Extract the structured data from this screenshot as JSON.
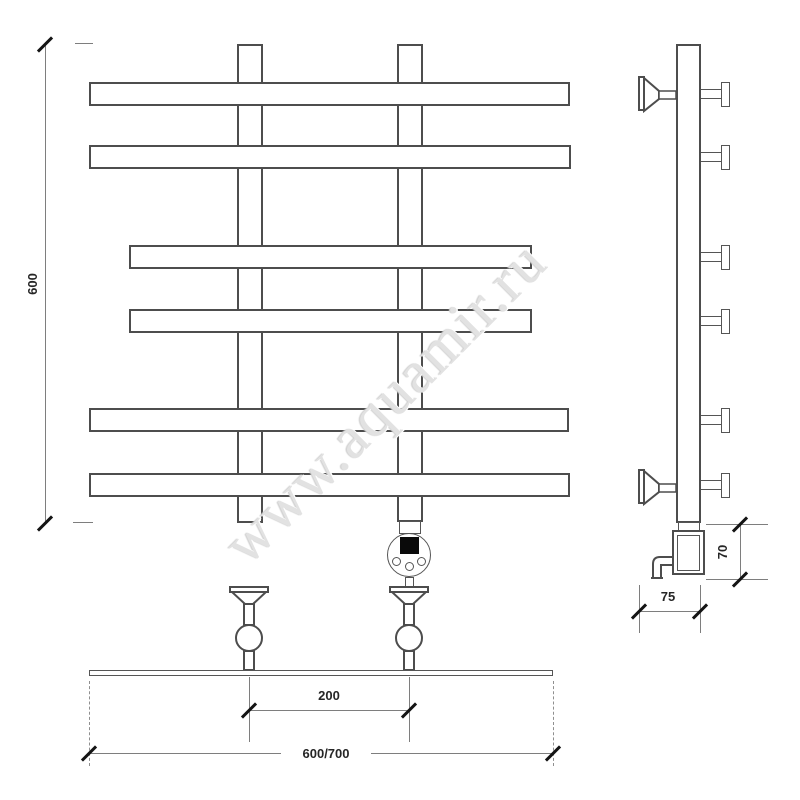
{
  "watermark": {
    "text": "www.aquamir.ru"
  },
  "dimensions": {
    "overall_height": "600",
    "connection_spacing": "200",
    "overall_width": "600/700",
    "wall_depth": "75",
    "heating_element_height": "70"
  }
}
